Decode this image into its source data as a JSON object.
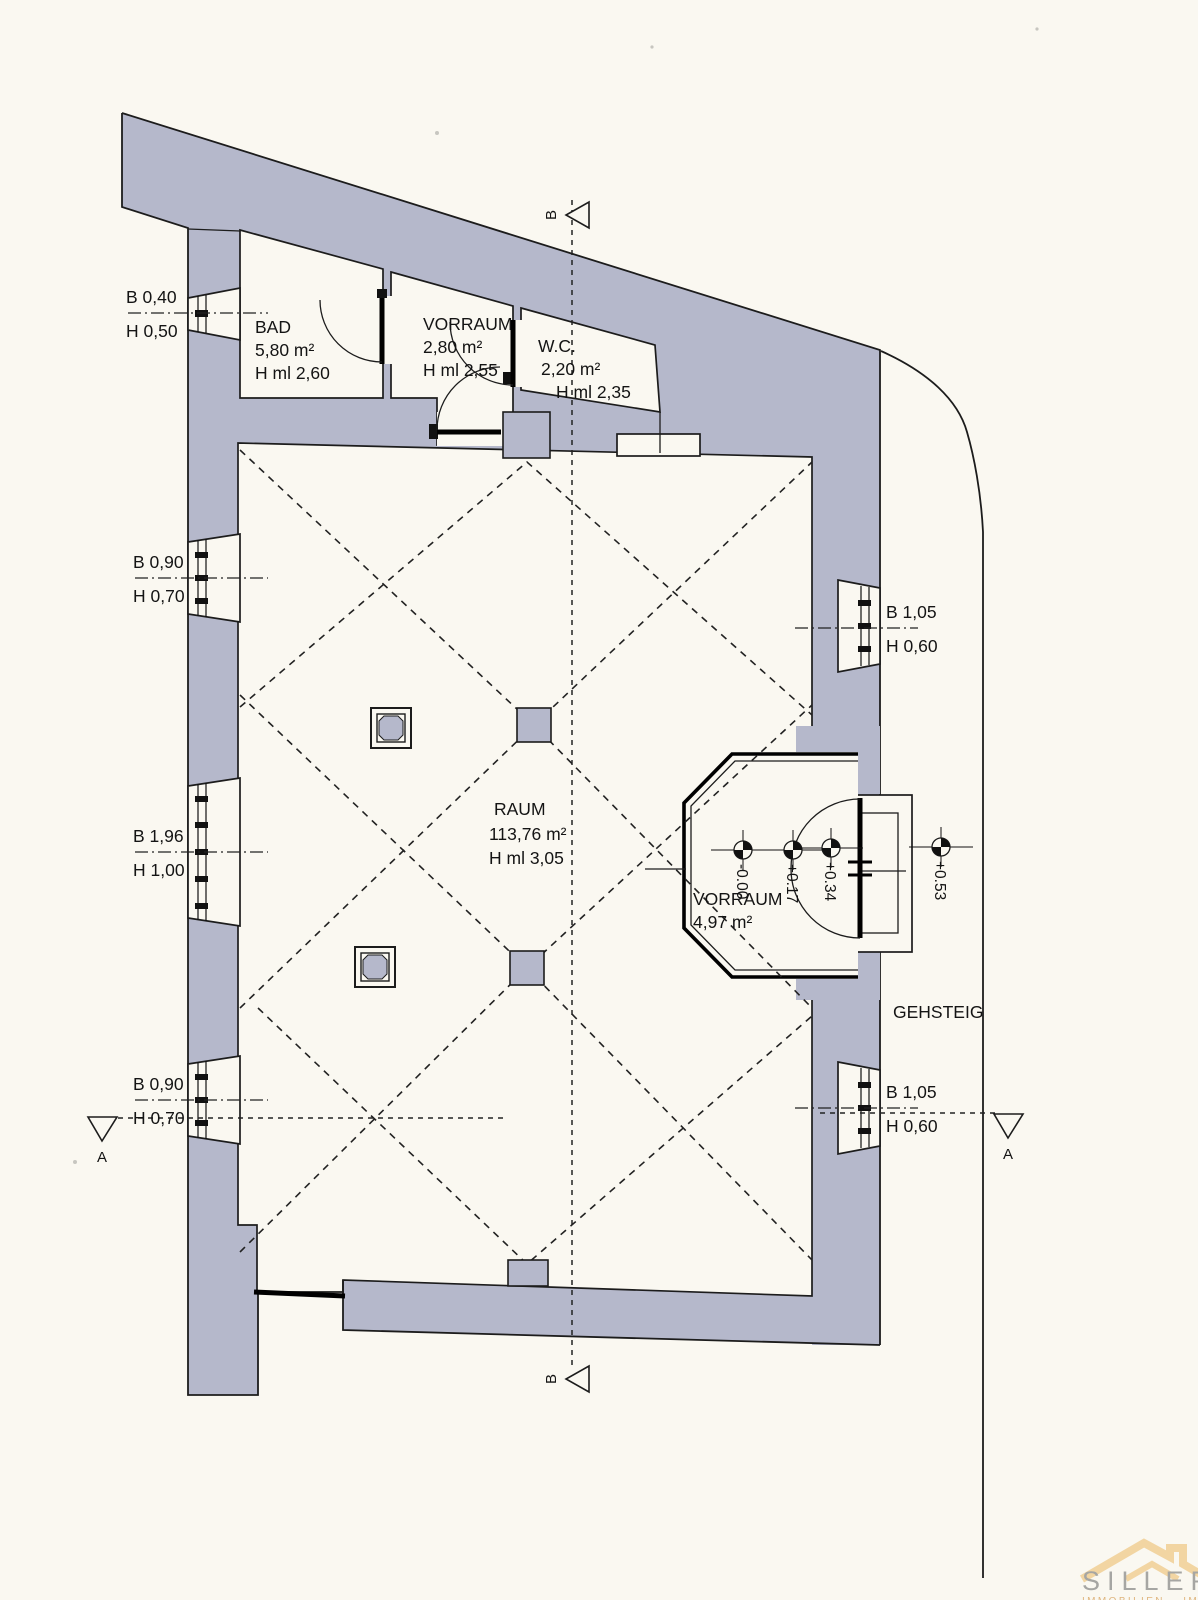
{
  "plan": {
    "rooms": {
      "bad": {
        "name": "BAD",
        "area": "5,80 m²",
        "height": "H ml 2,60"
      },
      "vorraum_top": {
        "name": "VORRAUM",
        "area": "2,80 m²",
        "height": "H ml 2,55"
      },
      "wc": {
        "name": "W.C.",
        "area": "2,20 m²",
        "height": "H ml 2,35"
      },
      "raum": {
        "name": "RAUM",
        "area": "113,76 m²",
        "height": "H ml 3,05"
      },
      "vorraum_entry": {
        "name": "VORRAUM",
        "area": "4,97 m²"
      },
      "gehsteig": {
        "name": "GEHSTEIG"
      }
    },
    "openings": {
      "left": [
        {
          "width": "B 0,40",
          "height": "H 0,50"
        },
        {
          "width": "B 0,90",
          "height": "H 0,70"
        },
        {
          "width": "B 1,96",
          "height": "H 1,00"
        },
        {
          "width": "B 0,90",
          "height": "H 0,70"
        }
      ],
      "right": [
        {
          "width": "B 1,05",
          "height": "H 0,60"
        },
        {
          "width": "B 1,05",
          "height": "H 0,60"
        }
      ]
    },
    "levels": [
      "-0.00",
      "+0.17",
      "+0.34",
      "+0.53"
    ],
    "sections": {
      "b_top": "B",
      "b_bottom": "B",
      "a_left": "A",
      "a_right": "A"
    }
  },
  "logo": {
    "name": "SILLER",
    "tagline": "IMMOBILIEN – IMMOBIL"
  },
  "colors": {
    "paper": "#faf8f1",
    "wall": "#b5b8cb",
    "line": "#1c1c1c",
    "logo_roof": "#f2d5a2",
    "logo_text": "#a6a6a3",
    "logo_tagline": "#dfb57e"
  }
}
